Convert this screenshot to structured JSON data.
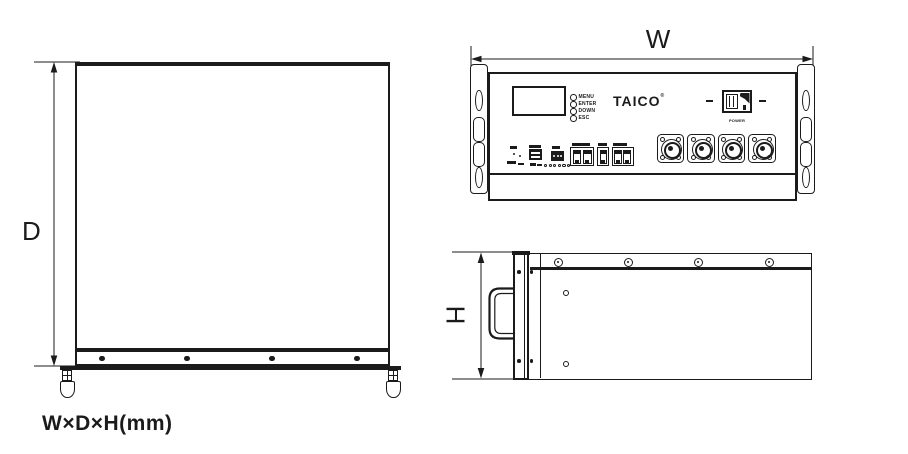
{
  "colors": {
    "ink": "#1b1b1b",
    "background": "#ffffff"
  },
  "dimension_labels": {
    "width": "W",
    "depth": "D",
    "height": "H",
    "formula": "W×D×H(mm)"
  },
  "front_view": {
    "brand": "TAICO",
    "brand_mark": "®",
    "led_labels": [
      "MENU",
      "ENTER",
      "DOWN",
      "ESC"
    ],
    "power_switch_label": "POWER",
    "terminal_symbols": [
      "+",
      "+",
      "−",
      "−"
    ]
  }
}
